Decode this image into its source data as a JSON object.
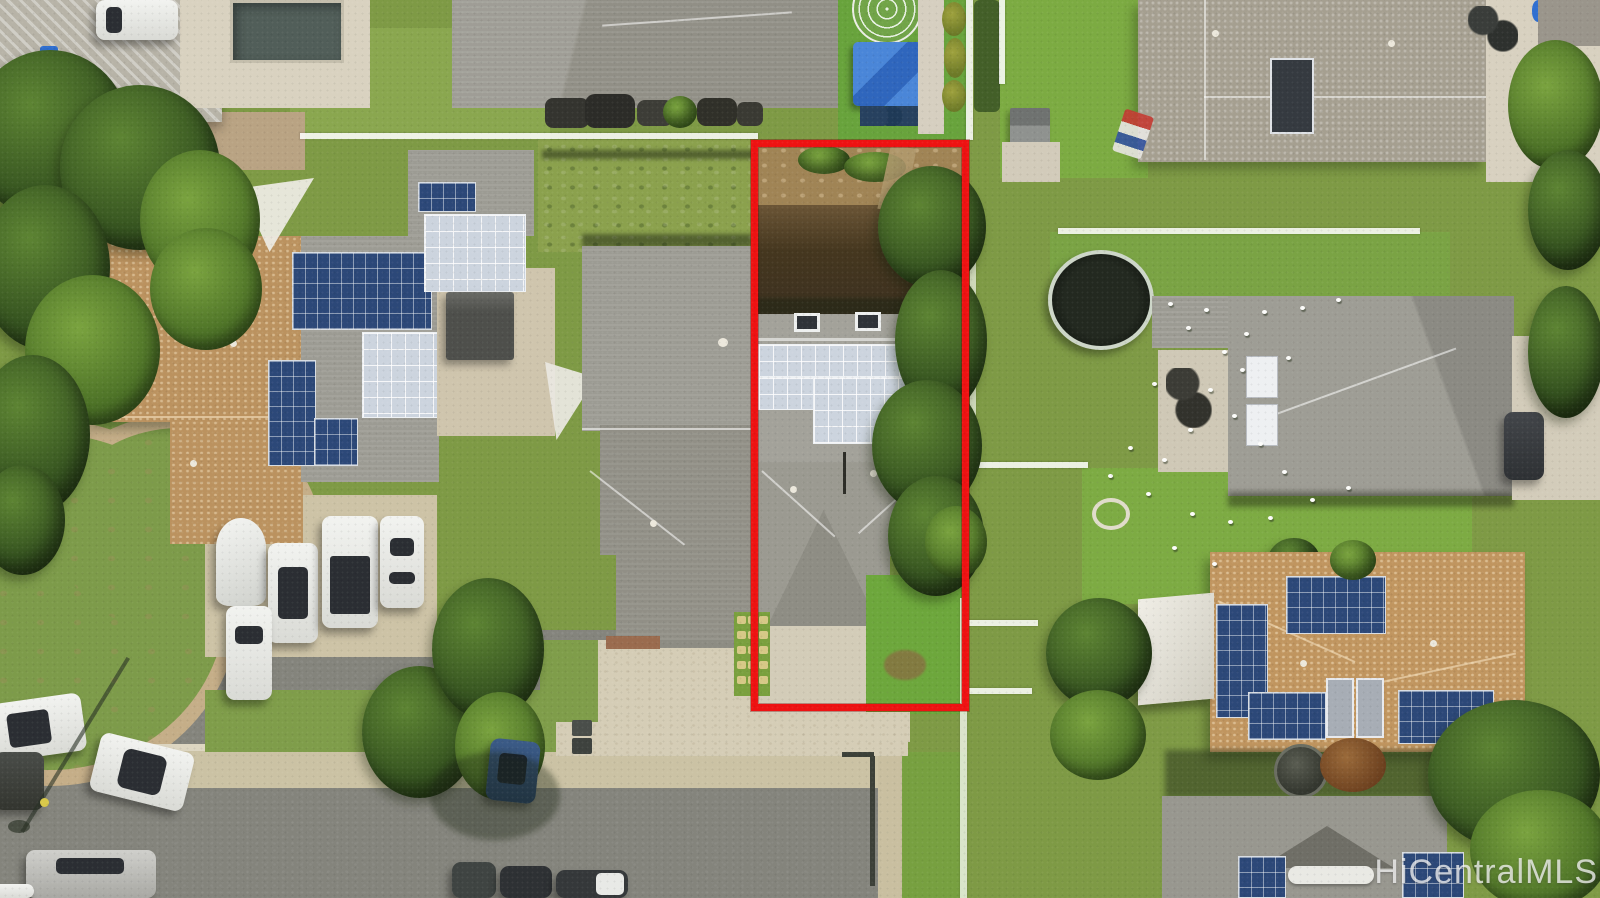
{
  "image": {
    "type_label": "aerial-photo",
    "watermark_text": "HiCentralMLS"
  },
  "highlight": {
    "name": "subject-property-boundary",
    "color": "#ee1212",
    "shape": "rectangle"
  },
  "colors": {
    "boundary_red": "#ee1212",
    "asphalt_gray": "#84847c",
    "concrete_tan": "#d5cdb6",
    "grass_green": "#7e9a45",
    "roof_gray": "#9c9b93",
    "roof_tan": "#bb925f",
    "solar_panel_blue": "#2c4878",
    "solar_panel_silver": "#ccd4de",
    "pool_gray": "#515e59",
    "tarp_blue": "#3e79cf",
    "watermark_white": "rgba(255,255,255,0.72)"
  },
  "scene": {
    "elements": [
      "subject-property-boundary",
      "subject-house-with-silver-solar-array",
      "neighbor-houses-with-blue-solar-panels",
      "residential-street-and-cul-de-sac",
      "parked-cars",
      "covered-boat",
      "swimming-pool",
      "geodesic-dome",
      "blue-tarp-canopy",
      "trampoline",
      "flock-of-white-birds",
      "trees-and-lawns",
      "mls-watermark"
    ]
  }
}
